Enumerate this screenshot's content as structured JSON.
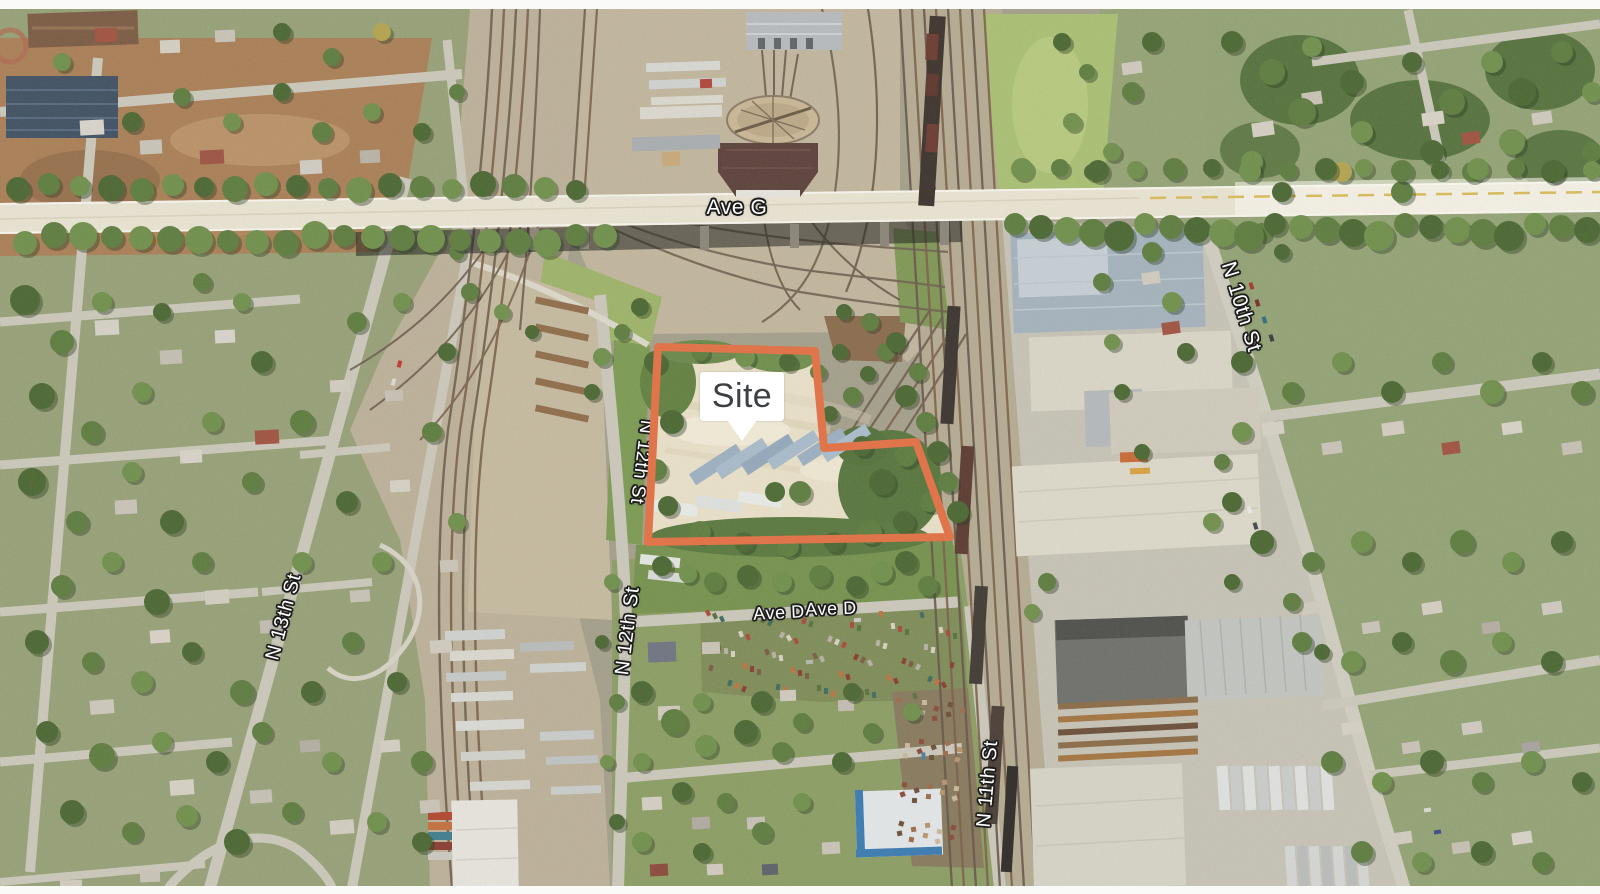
{
  "map": {
    "description": "Aerial imagery map of an industrial rail corridor area with a highlighted development site",
    "callout": {
      "label": "Site",
      "text_color": "#3c4043",
      "background": "#ffffff"
    },
    "site_outline": {
      "points": "658,347 815,351 824,448 916,442 950,537 648,542",
      "stroke_color": "#E0744B",
      "stroke_width": "8"
    },
    "street_labels": [
      {
        "id": "ave-g",
        "text": "Ave G"
      },
      {
        "id": "n-13th-st",
        "text": "N 13th St"
      },
      {
        "id": "n-12th-st-upper",
        "text": "N 12th St"
      },
      {
        "id": "n-12th-st-lower",
        "text": "N 12th St"
      },
      {
        "id": "ave-d-west",
        "text": "Ave D"
      },
      {
        "id": "ave-d-east",
        "text": "Ave D"
      },
      {
        "id": "n-11th-st",
        "text": "N 11th St"
      },
      {
        "id": "n-10th-st",
        "text": "N 10th St"
      }
    ]
  }
}
